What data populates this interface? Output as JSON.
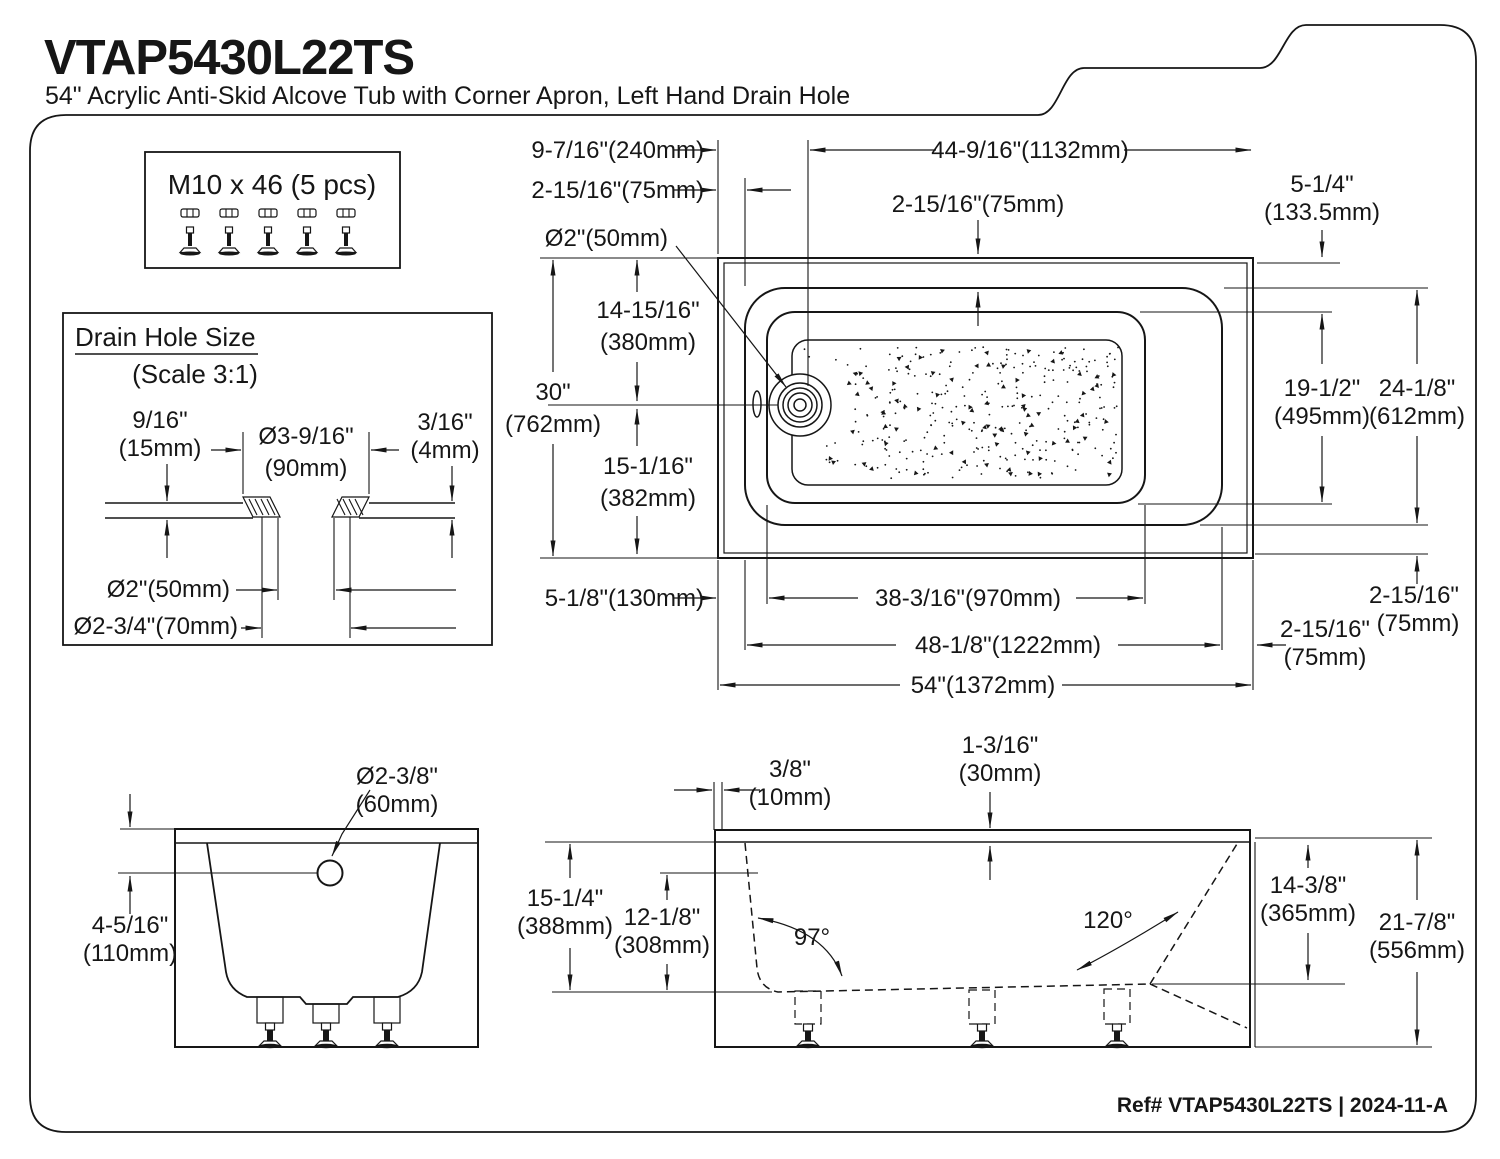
{
  "colors": {
    "ink": "#161616",
    "background": "#ffffff"
  },
  "page": {
    "title": "VTAP5430L22TS",
    "subtitle": "54\" Acrylic Anti-Skid Alcove Tub with Corner Apron, Left Hand Drain Hole",
    "footer": "Ref# VTAP5430L22TS | 2024-11-A"
  },
  "hardware_box": {
    "label": "M10 x 46 (5 pcs)",
    "count": 5
  },
  "drain_detail": {
    "title": "Drain Hole Size",
    "scale": "(Scale 3:1)",
    "flange_height_in": "9/16\"",
    "flange_height_mm": "(15mm)",
    "flange_od_in": "Ø3-9/16\"",
    "flange_od_mm": "(90mm)",
    "plate_thickness_in": "3/16\"",
    "plate_thickness_mm": "(4mm)",
    "hole_id": "Ø2\"(50mm)",
    "flange_opening": "Ø2-3/4\"(70mm)"
  },
  "top_view": {
    "drain_offset": "9-7/16\"(240mm)",
    "apron_overhang_left": "2-15/16\"(75mm)",
    "drain_dia": "Ø2\"(50mm)",
    "drain_to_right": "44-9/16\"(1132mm)",
    "rim_width_top": "2-15/16\"(75mm)",
    "corner_ext_in": "5-1/4\"",
    "corner_ext_mm": "(133.5mm)",
    "width_in": "30\"",
    "width_mm": "(762mm)",
    "drain_cl_top_in": "14-15/16\"",
    "drain_cl_top_mm": "(380mm)",
    "drain_cl_bottom_in": "15-1/16\"",
    "drain_cl_bottom_mm": "(382mm)",
    "basin_width_in": "19-1/2\"",
    "basin_width_mm": "(495mm)",
    "rim_width_in": "24-1/8\"",
    "rim_width_mm": "(612mm)",
    "skirt_left": "5-1/8\"(130mm)",
    "basin_length": "38-3/16\"(970mm)",
    "rim_length": "48-1/8\"(1222mm)",
    "overall_length": "54\"(1372mm)",
    "rim_right_in": "2-15/16\"",
    "rim_right_mm": "(75mm)",
    "rim_bottom_in": "2-15/16\"",
    "rim_bottom_mm": "(75mm)"
  },
  "end_view": {
    "overflow_dia_in": "Ø2-3/8\"",
    "overflow_dia_mm": "(60mm)",
    "overflow_drop_in": "4-5/16\"",
    "overflow_drop_mm": "(110mm)"
  },
  "side_view": {
    "lip_in": "3/8\"",
    "lip_mm": "(10mm)",
    "deck_thickness_in": "1-3/16\"",
    "deck_thickness_mm": "(30mm)",
    "depth_in": "15-1/4\"",
    "depth_mm": "(388mm)",
    "water_depth_in": "12-1/8\"",
    "water_depth_mm": "(308mm)",
    "wall_angle": "97°",
    "slope_angle": "120°",
    "inner_height_in": "14-3/8\"",
    "inner_height_mm": "(365mm)",
    "overall_height_in": "21-7/8\"",
    "overall_height_mm": "(556mm)"
  }
}
